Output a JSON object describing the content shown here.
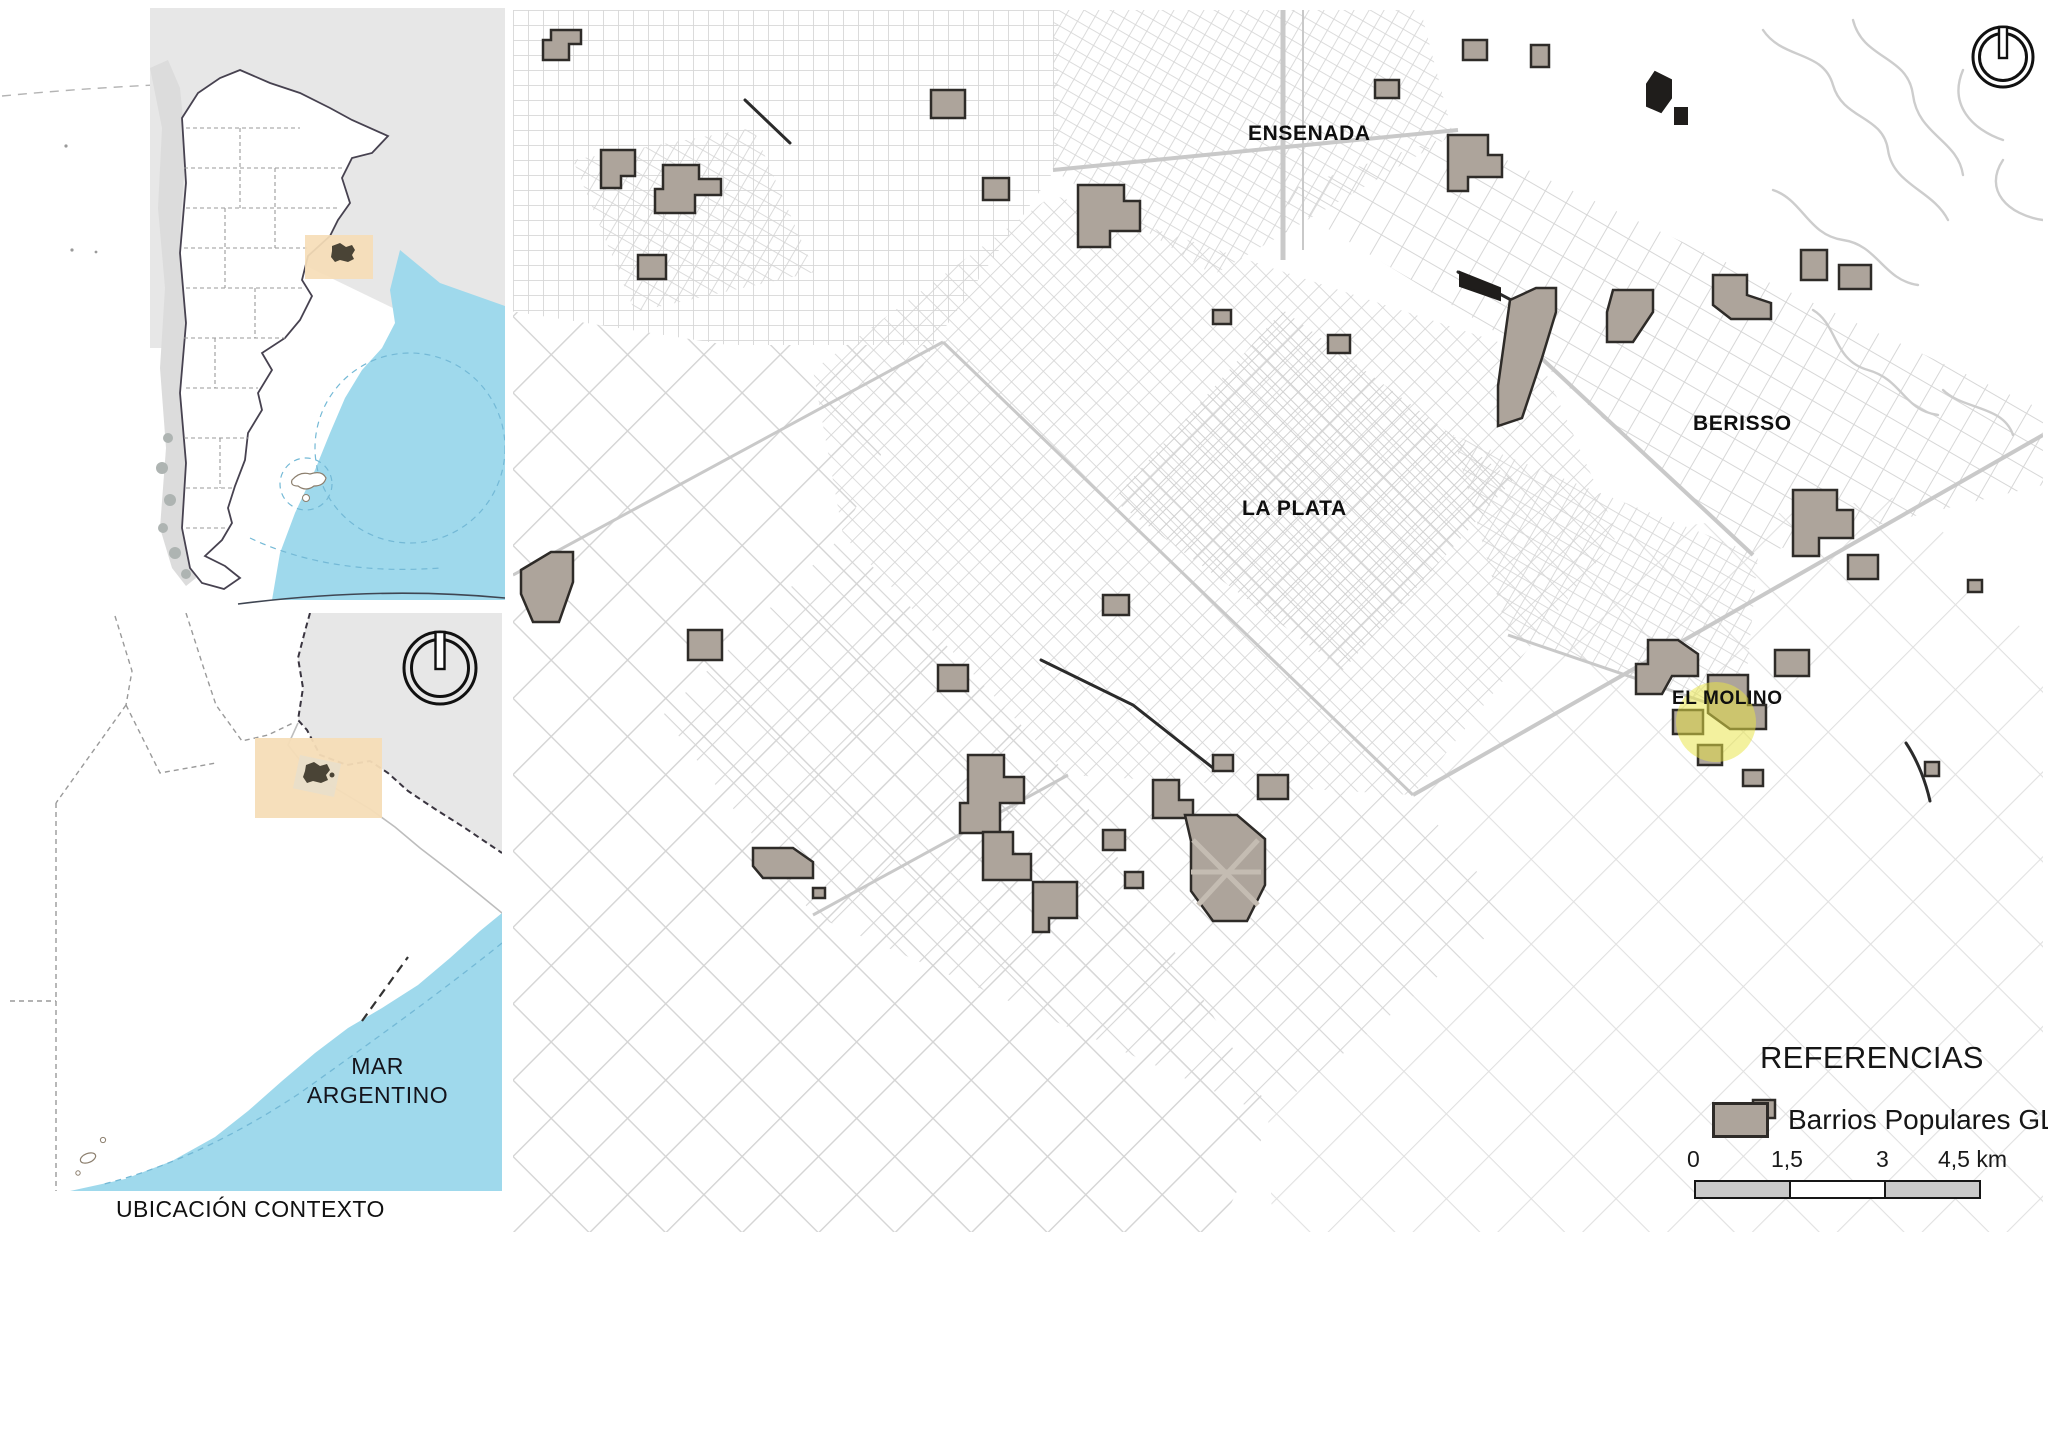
{
  "figure": {
    "caption": "UBICACIÓN CONTEXTO"
  },
  "inset_country": {
    "description": "Argentina national location inset with highlighted Buenos Aires / La Plata box"
  },
  "inset_province": {
    "sea_label": [
      "MAR",
      "ARGENTINO"
    ],
    "description": "Buenos Aires province inset with highlighted La Plata region box and north compass"
  },
  "main_map": {
    "labels": {
      "ensenada": "ENSENADA",
      "la_plata": "LA PLATA",
      "berisso": "BERISSO",
      "el_molino": "EL MOLINO"
    }
  },
  "legend": {
    "title": "REFERENCIAS",
    "items": [
      {
        "label": "Barrios Populares GLP",
        "swatch_color": "#ada49b"
      }
    ]
  },
  "scale_bar": {
    "ticks": [
      "0",
      "1,5",
      "3",
      "4,5 km"
    ],
    "segments": 3
  },
  "colors": {
    "ink": "#111111",
    "street_grid": "#d7d7d7",
    "road_gray": "#c9c9c9",
    "barrio_fill": "#ada49b",
    "barrio_stroke": "#2e2b28",
    "barrio_dark": "#1f1d1b",
    "sea_blue": "#9fd9ec",
    "neighbor_gray": "#e7e7e7",
    "chile_gray": "#dcdcdc",
    "highlight_orange": "#f6ddb7",
    "highlight_yellow": "#e8e545",
    "urban_blob": "#4a4436",
    "scalebar_gray": "#c9c9c9",
    "railway": "#2b2b2b",
    "wetland": "#cdcdcd",
    "border_dark": "#3a3540",
    "dashed_gray": "#9a9a9a"
  }
}
